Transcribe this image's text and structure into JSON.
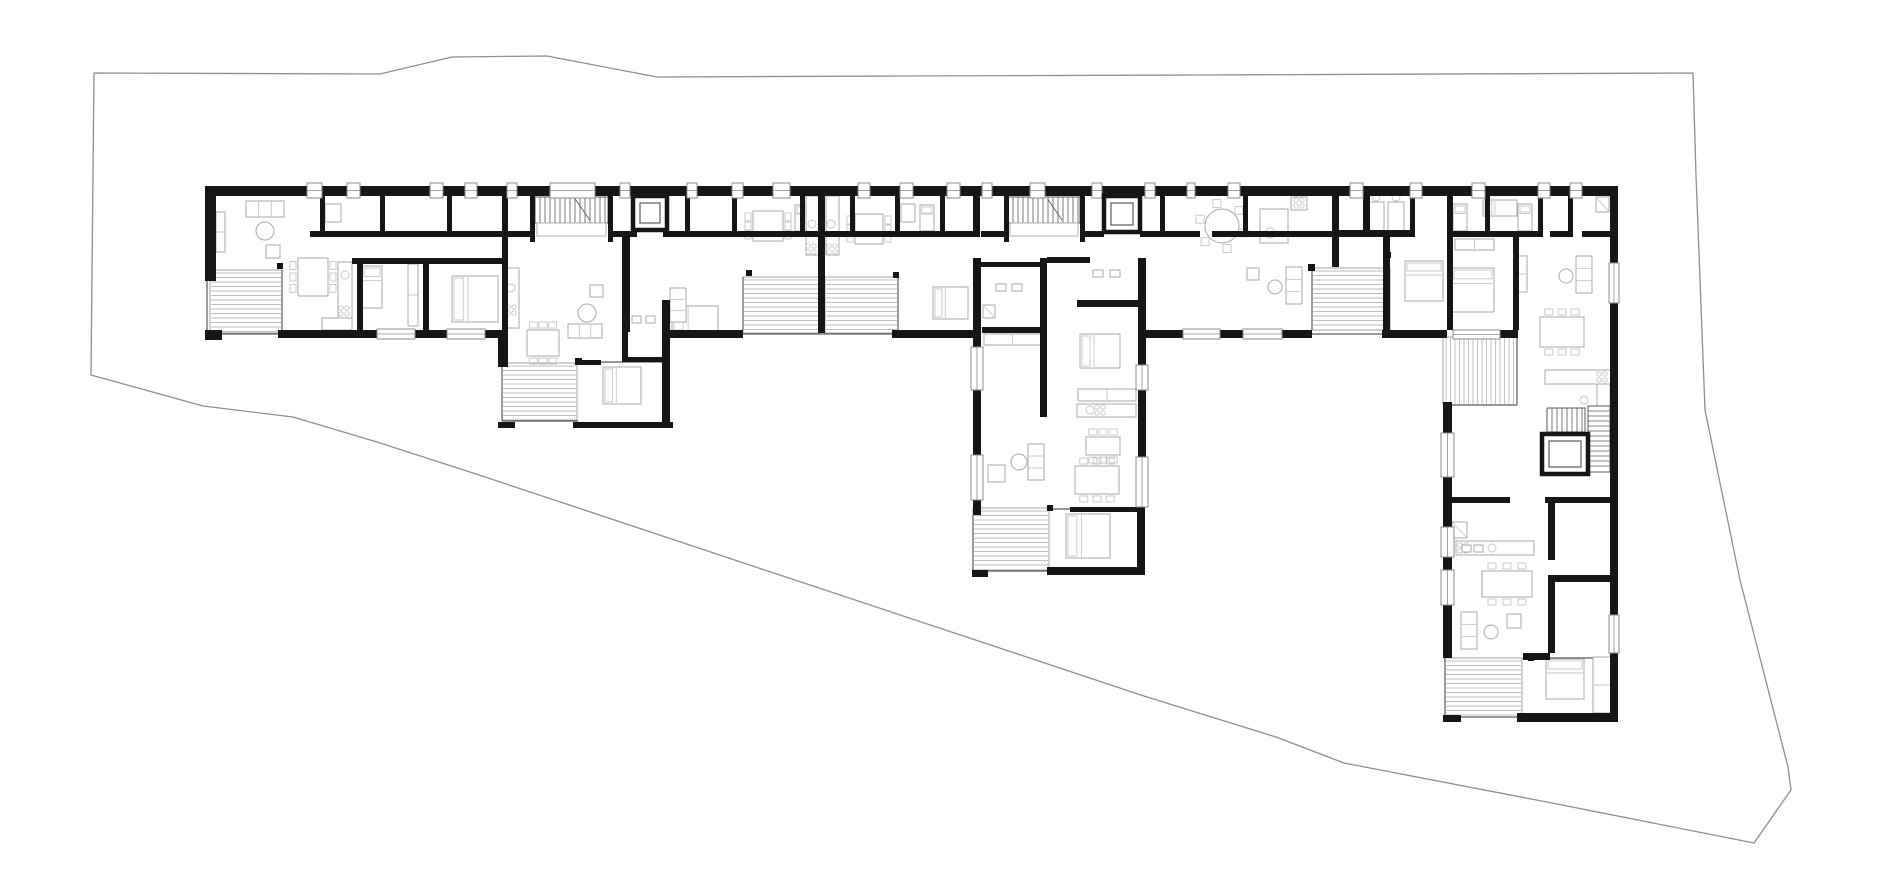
{
  "canvas": {
    "width": 1880,
    "height": 883
  },
  "colors": {
    "background": "#ffffff",
    "wall": "#161616",
    "thin": "#5a5a5a",
    "furniture": "#a9a9a9",
    "furniture_light": "#c6c6c6",
    "hatch_line": "#bdbdbd",
    "hatch_border": "#9a9a9a",
    "boundary": "#8f8f8f",
    "window_fill": "#ffffff",
    "window_border": "#8c8c8c"
  },
  "site_boundary": {
    "points": [
      [
        94,
        73
      ],
      [
        380,
        74
      ],
      [
        452,
        57
      ],
      [
        547,
        56
      ],
      [
        657,
        77
      ],
      [
        900,
        76
      ],
      [
        1200,
        75
      ],
      [
        1693,
        73
      ],
      [
        1696,
        175
      ],
      [
        1705,
        410
      ],
      [
        1740,
        580
      ],
      [
        1788,
        767
      ],
      [
        1791,
        790
      ],
      [
        1754,
        843
      ],
      [
        1552,
        803
      ],
      [
        1344,
        763
      ],
      [
        1276,
        737
      ],
      [
        1147,
        697
      ],
      [
        473,
        473
      ],
      [
        377,
        442
      ],
      [
        293,
        417
      ],
      [
        203,
        406
      ],
      [
        91,
        375
      ]
    ]
  },
  "building": {
    "top_wall": {
      "x": 205,
      "y": 186,
      "w": 1413,
      "h": 10
    },
    "top_windows": [
      [
        307,
        322
      ],
      [
        347,
        360
      ],
      [
        430,
        443
      ],
      [
        465,
        477
      ],
      [
        507,
        517
      ],
      [
        550,
        595
      ],
      [
        620,
        630
      ],
      [
        687,
        697
      ],
      [
        732,
        743
      ],
      [
        773,
        790
      ],
      [
        858,
        870
      ],
      [
        900,
        913
      ],
      [
        947,
        960
      ],
      [
        982,
        992
      ],
      [
        1030,
        1045
      ],
      [
        1092,
        1102
      ],
      [
        1145,
        1155
      ],
      [
        1187,
        1195
      ],
      [
        1228,
        1240
      ],
      [
        1350,
        1363
      ],
      [
        1410,
        1422
      ],
      [
        1472,
        1485
      ],
      [
        1538,
        1550
      ],
      [
        1570,
        1582
      ]
    ],
    "walls": [
      [
        205,
        330,
        17,
        10
      ],
      [
        278,
        330,
        99,
        8
      ],
      [
        415,
        330,
        32,
        8
      ],
      [
        485,
        330,
        15,
        8
      ],
      [
        667,
        330,
        76,
        8
      ],
      [
        892,
        330,
        81,
        8
      ],
      [
        1145,
        330,
        38,
        8
      ],
      [
        1220,
        330,
        23,
        8
      ],
      [
        1282,
        330,
        30,
        8
      ],
      [
        1382,
        330,
        65,
        8
      ],
      [
        1500,
        330,
        18,
        8
      ],
      [
        205,
        186,
        11,
        95
      ],
      [
        1610,
        186,
        8,
        81
      ],
      [
        1610,
        301,
        8,
        316
      ],
      [
        1610,
        651,
        8,
        71
      ],
      [
        310,
        231,
        225,
        6
      ],
      [
        608,
        231,
        29,
        6
      ],
      [
        663,
        231,
        155,
        6
      ],
      [
        825,
        231,
        148,
        6
      ],
      [
        981,
        231,
        27,
        6
      ],
      [
        1080,
        231,
        24,
        6
      ],
      [
        1140,
        231,
        60,
        6
      ],
      [
        1212,
        231,
        120,
        6
      ],
      [
        1333,
        230,
        80,
        7
      ],
      [
        1453,
        231,
        85,
        6
      ],
      [
        1550,
        231,
        20,
        6
      ],
      [
        1582,
        231,
        28,
        6
      ],
      [
        352,
        258,
        150,
        6
      ],
      [
        981,
        262,
        60,
        5
      ],
      [
        1047,
        257,
        43,
        6
      ],
      [
        1077,
        300,
        61,
        7
      ],
      [
        982,
        327,
        61,
        6
      ],
      [
        320,
        196,
        5,
        41
      ],
      [
        380,
        196,
        5,
        41
      ],
      [
        447,
        196,
        5,
        41
      ],
      [
        530,
        196,
        5,
        46
      ],
      [
        608,
        196,
        5,
        46
      ],
      [
        685,
        196,
        5,
        41
      ],
      [
        732,
        196,
        5,
        41
      ],
      [
        800,
        196,
        5,
        41
      ],
      [
        850,
        196,
        5,
        41
      ],
      [
        895,
        196,
        5,
        41
      ],
      [
        940,
        196,
        5,
        41
      ],
      [
        1004,
        196,
        5,
        46
      ],
      [
        1080,
        196,
        5,
        46
      ],
      [
        1160,
        196,
        5,
        41
      ],
      [
        1243,
        196,
        5,
        41
      ],
      [
        1410,
        196,
        5,
        41
      ],
      [
        1485,
        196,
        5,
        41
      ],
      [
        1538,
        196,
        5,
        41
      ],
      [
        1568,
        196,
        5,
        41
      ],
      [
        357,
        260,
        6,
        72
      ],
      [
        423,
        260,
        6,
        72
      ],
      [
        502,
        196,
        6,
        171
      ],
      [
        622,
        237,
        8,
        95
      ],
      [
        662,
        300,
        8,
        128
      ],
      [
        818,
        196,
        7,
        137
      ],
      [
        973,
        196,
        7,
        41
      ],
      [
        1332,
        196,
        7,
        71
      ],
      [
        1363,
        196,
        7,
        41
      ],
      [
        1447,
        196,
        6,
        134
      ],
      [
        1513,
        231,
        6,
        99
      ],
      [
        1383,
        237,
        7,
        93
      ],
      [
        973,
        258,
        8,
        89
      ],
      [
        973,
        390,
        8,
        65
      ],
      [
        973,
        500,
        8,
        15
      ],
      [
        972,
        570,
        16,
        7
      ],
      [
        1040,
        258,
        7,
        159
      ],
      [
        1138,
        258,
        8,
        107
      ],
      [
        1138,
        390,
        8,
        67
      ],
      [
        1137,
        507,
        8,
        68
      ],
      [
        1047,
        567,
        98,
        8
      ],
      [
        1070,
        507,
        73,
        5
      ],
      [
        498,
        330,
        7,
        37
      ],
      [
        498,
        422,
        17,
        6
      ],
      [
        573,
        422,
        100,
        6
      ],
      [
        577,
        360,
        24,
        5
      ],
      [
        622,
        300,
        6,
        60
      ],
      [
        622,
        357,
        41,
        5
      ],
      [
        1443,
        402,
        9,
        31
      ],
      [
        1443,
        477,
        9,
        50
      ],
      [
        1443,
        557,
        9,
        13
      ],
      [
        1443,
        605,
        9,
        53
      ],
      [
        1443,
        715,
        18,
        7
      ],
      [
        1450,
        497,
        60,
        6
      ],
      [
        1545,
        497,
        67,
        6
      ],
      [
        1523,
        653,
        27,
        7
      ],
      [
        1553,
        575,
        64,
        7
      ],
      [
        1548,
        503,
        7,
        57
      ],
      [
        1548,
        575,
        7,
        78
      ],
      [
        1517,
        713,
        101,
        9
      ]
    ],
    "windows": [
      [
        377,
        329,
        38,
        10
      ],
      [
        447,
        329,
        38,
        10
      ],
      [
        1183,
        329,
        37,
        10
      ],
      [
        1243,
        329,
        39,
        10
      ],
      [
        1609,
        263,
        10,
        40
      ],
      [
        1609,
        615,
        10,
        38
      ],
      [
        1441,
        433,
        13,
        44
      ],
      [
        1441,
        527,
        13,
        30
      ],
      [
        1441,
        570,
        13,
        35
      ],
      [
        971,
        347,
        12,
        43
      ],
      [
        971,
        455,
        12,
        45
      ],
      [
        1136,
        365,
        12,
        25
      ],
      [
        1136,
        457,
        12,
        50
      ],
      [
        1453,
        330,
        47,
        9
      ]
    ],
    "thin_lines": [
      [
        222,
        334,
        278,
        334
      ],
      [
        743,
        334,
        898,
        334
      ],
      [
        1312,
        334,
        1382,
        334
      ],
      [
        207,
        281,
        207,
        333
      ],
      [
        282,
        270,
        282,
        333
      ],
      [
        743,
        277,
        743,
        330
      ],
      [
        898,
        277,
        898,
        330
      ],
      [
        1312,
        268,
        1312,
        330
      ],
      [
        502,
        367,
        502,
        421
      ],
      [
        502,
        421,
        578,
        421
      ],
      [
        600,
        362,
        662,
        362
      ],
      [
        973,
        515,
        973,
        570
      ],
      [
        973,
        571,
        1047,
        571
      ],
      [
        1445,
        658,
        1445,
        716
      ],
      [
        1445,
        717,
        1517,
        717
      ],
      [
        1443,
        405,
        1517,
        405
      ],
      [
        1517,
        337,
        1517,
        405
      ],
      [
        1053,
        509,
        1070,
        509
      ],
      [
        1525,
        658,
        1610,
        658
      ]
    ],
    "terraces": [
      {
        "x": 210,
        "y": 270,
        "w": 72,
        "h": 63,
        "dir": "h"
      },
      {
        "x": 743,
        "y": 277,
        "w": 77,
        "h": 56,
        "dir": "h"
      },
      {
        "x": 825,
        "y": 277,
        "w": 73,
        "h": 56,
        "dir": "h"
      },
      {
        "x": 1312,
        "y": 268,
        "w": 78,
        "h": 62,
        "dir": "h"
      },
      {
        "x": 502,
        "y": 363,
        "w": 75,
        "h": 57,
        "dir": "h"
      },
      {
        "x": 973,
        "y": 508,
        "w": 76,
        "h": 62,
        "dir": "h"
      },
      {
        "x": 1445,
        "y": 658,
        "w": 77,
        "h": 59,
        "dir": "h"
      },
      {
        "x": 1443,
        "y": 337,
        "w": 74,
        "h": 68,
        "dir": "v"
      }
    ],
    "stairs": [
      {
        "x": 535,
        "y": 197,
        "w": 73,
        "h": 26,
        "dir": "v",
        "landing": [
          537,
          223,
          69,
          13
        ]
      },
      {
        "x": 1008,
        "y": 197,
        "w": 72,
        "h": 26,
        "dir": "v",
        "landing": [
          1010,
          223,
          68,
          13
        ]
      },
      {
        "x": 1588,
        "y": 406,
        "w": 22,
        "h": 66,
        "dir": "h"
      },
      {
        "x": 1547,
        "y": 408,
        "w": 38,
        "h": 24,
        "dir": "v"
      }
    ],
    "elevators": [
      [
        633,
        196,
        34,
        34
      ],
      [
        1104,
        196,
        36,
        36
      ],
      [
        1542,
        434,
        46,
        40
      ]
    ],
    "posts": [
      [
        277,
        263,
        6,
        6
      ],
      [
        746,
        270,
        6,
        6
      ],
      [
        893,
        272,
        6,
        6
      ],
      [
        1308,
        264,
        7,
        7
      ],
      [
        1385,
        252,
        6,
        6
      ],
      [
        575,
        358,
        7,
        7
      ],
      [
        1047,
        505,
        6,
        6
      ],
      [
        1528,
        655,
        6,
        6
      ]
    ]
  },
  "furniture": {
    "beds": [
      [
        362,
        266,
        20,
        42
      ],
      [
        452,
        276,
        46,
        46
      ],
      [
        603,
        367,
        38,
        37
      ],
      [
        672,
        306,
        46,
        26
      ],
      [
        933,
        287,
        35,
        32
      ],
      [
        1080,
        334,
        40,
        34
      ],
      [
        1066,
        514,
        44,
        44
      ],
      [
        1405,
        261,
        38,
        40
      ],
      [
        1452,
        268,
        42,
        44
      ],
      [
        1546,
        659,
        38,
        40
      ],
      [
        1453,
        204,
        14,
        27
      ],
      [
        1518,
        204,
        14,
        27
      ],
      [
        920,
        205,
        14,
        26
      ],
      [
        795,
        205,
        14,
        26
      ],
      [
        1483,
        200,
        34,
        16
      ]
    ],
    "round_tables": [
      [
        265,
        231,
        9
      ],
      [
        587,
        313,
        9
      ],
      [
        1019,
        462,
        8
      ],
      [
        1222,
        226,
        17
      ],
      [
        1275,
        287,
        7
      ],
      [
        1566,
        276,
        7
      ],
      [
        1491,
        632,
        7
      ]
    ],
    "dining_tables": [
      [
        298,
        258,
        30,
        38
      ],
      [
        753,
        211,
        30,
        30
      ],
      [
        855,
        214,
        28,
        30
      ],
      [
        527,
        330,
        32,
        26
      ],
      [
        1075,
        466,
        44,
        28
      ],
      [
        1540,
        317,
        44,
        30
      ],
      [
        1482,
        571,
        50,
        26
      ],
      [
        1086,
        437,
        34,
        18
      ]
    ],
    "small_squares": [
      [
        266,
        245,
        14,
        13
      ],
      [
        590,
        285,
        13,
        12
      ],
      [
        988,
        465,
        17,
        17
      ],
      [
        1507,
        614,
        14,
        14
      ],
      [
        1247,
        268,
        12,
        12
      ],
      [
        325,
        204,
        16,
        18
      ],
      [
        901,
        204,
        14,
        18
      ]
    ],
    "desks": [
      [
        1368,
        202,
        16,
        30
      ],
      [
        1388,
        202,
        16,
        30
      ]
    ],
    "sofas": [
      [
        246,
        201,
        38,
        16
      ],
      [
        568,
        324,
        34,
        14
      ],
      [
        1286,
        267,
        16,
        37
      ],
      [
        1576,
        256,
        16,
        37
      ],
      [
        1461,
        612,
        16,
        37
      ],
      [
        1028,
        444,
        16,
        36
      ],
      [
        670,
        288,
        16,
        34
      ]
    ],
    "wardrobes": [
      [
        408,
        264,
        10,
        62
      ],
      [
        984,
        334,
        57,
        11
      ],
      [
        1078,
        389,
        58,
        12
      ],
      [
        1455,
        239,
        39,
        11
      ],
      [
        1593,
        657,
        18,
        56
      ],
      [
        216,
        212,
        9,
        40
      ],
      [
        1518,
        256,
        9,
        36
      ]
    ],
    "counters": [
      [
        338,
        262,
        14,
        56
      ],
      [
        322,
        318,
        30,
        12
      ],
      [
        505,
        268,
        14,
        60
      ],
      [
        806,
        196,
        13,
        59
      ],
      [
        826,
        196,
        13,
        59
      ],
      [
        1260,
        209,
        28,
        34
      ],
      [
        1291,
        197,
        16,
        13
      ],
      [
        1545,
        370,
        66,
        14
      ],
      [
        1597,
        384,
        13,
        26
      ],
      [
        1077,
        404,
        59,
        13
      ],
      [
        1456,
        541,
        78,
        14
      ]
    ],
    "burners": [
      [
        811,
        249
      ],
      [
        832,
        249
      ],
      [
        1299,
        203
      ],
      [
        1463,
        548
      ],
      [
        1602,
        377
      ],
      [
        1100,
        410
      ],
      [
        511,
        310
      ],
      [
        344,
        311
      ]
    ],
    "sinks": [
      [
        345,
        275,
        4
      ],
      [
        511,
        288,
        4
      ],
      [
        812,
        224,
        4
      ],
      [
        831,
        224,
        4
      ],
      [
        1270,
        233,
        5
      ],
      [
        1584,
        400,
        4
      ],
      [
        1090,
        410,
        4
      ],
      [
        1492,
        548,
        4
      ]
    ],
    "showers": [
      [
        983,
        305,
        12,
        13
      ],
      [
        1452,
        522,
        15,
        16
      ],
      [
        1596,
        197,
        13,
        15
      ]
    ],
    "bath_items": [
      [
        996,
        284,
        10,
        7
      ],
      [
        1012,
        284,
        10,
        7
      ],
      [
        1093,
        270,
        10,
        7
      ],
      [
        1110,
        270,
        10,
        7
      ],
      [
        632,
        316,
        9,
        7
      ],
      [
        646,
        316,
        9,
        7
      ],
      [
        1462,
        545,
        9,
        7
      ],
      [
        1474,
        545,
        9,
        7
      ]
    ]
  }
}
